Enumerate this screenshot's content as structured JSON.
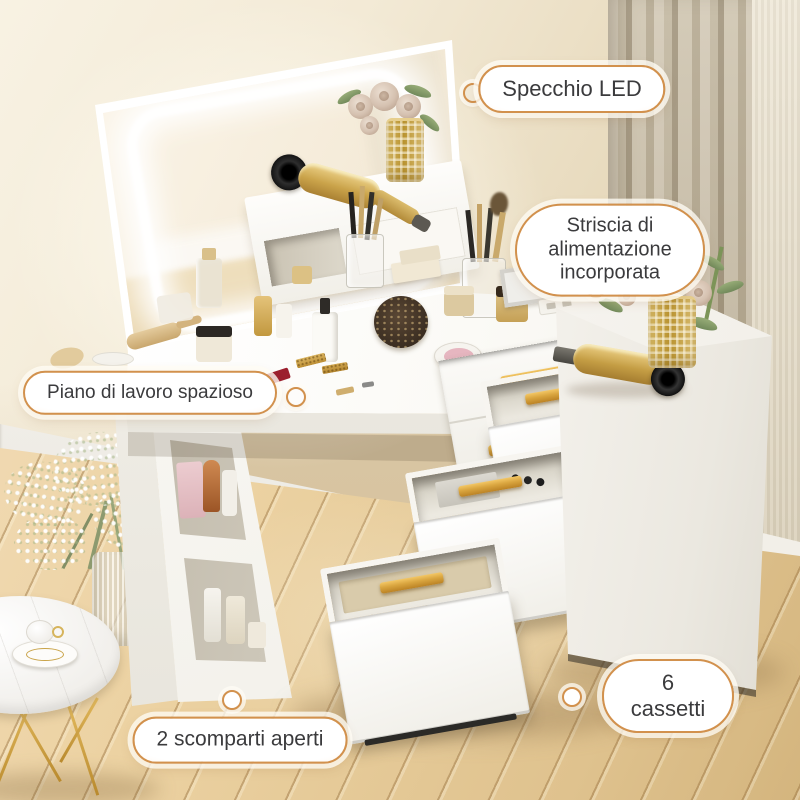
{
  "callouts": {
    "mirror_led": {
      "label": "Specchio LED"
    },
    "power_strip": {
      "label": "Striscia di\nalimentazione incorporata"
    },
    "worktop": {
      "label": "Piano di lavoro spazioso"
    },
    "open_shelves": {
      "label": "2 scomparti aperti"
    },
    "drawers": {
      "label": "6 cassetti"
    }
  },
  "style": {
    "accent": "#d2914d",
    "pill_fill_edge": "#f7d8b2",
    "pill_text": "#3b3b3d",
    "gold": "#d9a53f",
    "wall": "#eee3c9",
    "floor_wood": "#ecd2a4",
    "furniture_white": "#fbfaf6"
  }
}
